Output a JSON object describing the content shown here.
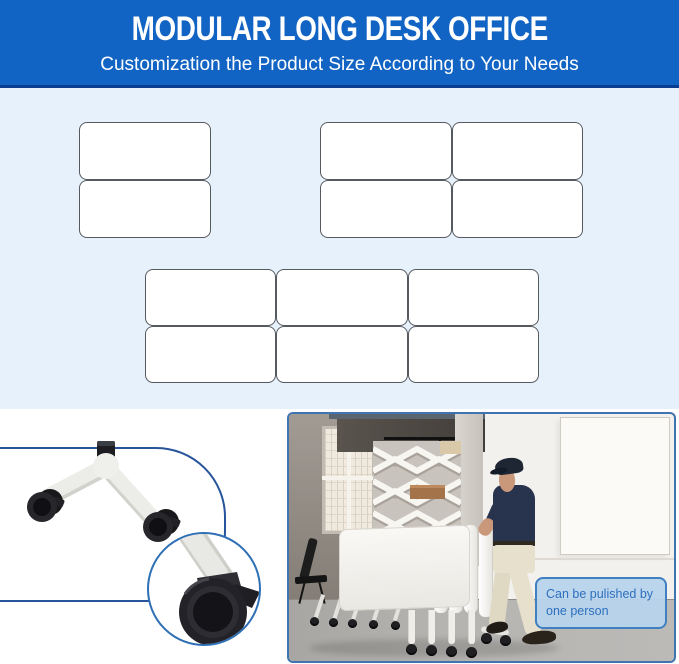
{
  "banner": {
    "title": "MODULAR LONG DESK OFFICE",
    "subtitle": "Customization the Product Size According to Your Needs",
    "bg_color": "#1264C4",
    "accent_line_color": "#0A3D8F"
  },
  "size_options": {
    "bg_color": "#E7F1FB",
    "desk_layouts": [
      {
        "name": "two-desk-column",
        "rows": 2,
        "cols": 1
      },
      {
        "name": "four-desk-grid",
        "rows": 2,
        "cols": 2
      },
      {
        "name": "six-desk-grid",
        "rows": 2,
        "cols": 3
      }
    ]
  },
  "detail_panel": {
    "frame_color": "#27549A",
    "zoom_ring_color": "#2E6FB5",
    "subject": "caster-wheel-leg"
  },
  "photo": {
    "border_color": "#3F74B0",
    "caption": {
      "label": "Can be pulished by one person",
      "text_color": "#2D6FBE",
      "bg_color": "#B7D3EC",
      "border_color": "#4080C0"
    }
  }
}
